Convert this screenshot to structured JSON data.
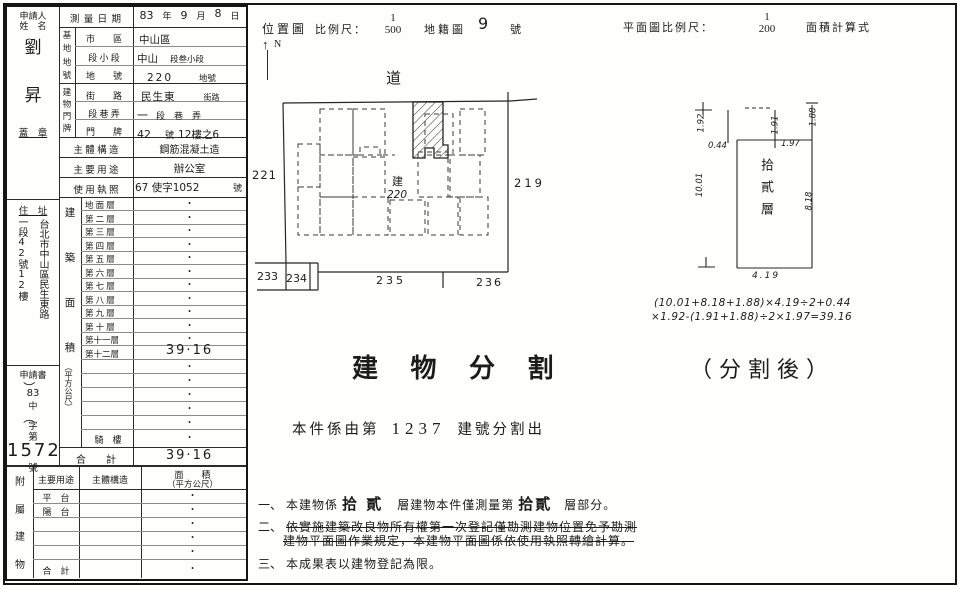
{
  "form": {
    "applicant": {
      "title_1": "申請人",
      "title_2": "姓　名",
      "name_1": "劉",
      "name_2": "昇",
      "seal": "蓋　章",
      "address_label": "住　址",
      "address_line_1": "台北市中山區民生東路",
      "address_line_2": "一段42號12樓",
      "app_doc": "申請書",
      "app_paren_open": "（",
      "app_year": "83",
      "app_mid": "中",
      "app_paren_close": "）",
      "app_word": "字",
      "app_no_label": "第",
      "app_number": "1572",
      "app_unit": "號"
    },
    "survey_date": {
      "label": "測 量 日 期",
      "year": "83",
      "year_u": "年",
      "month": "9",
      "month_u": "月",
      "day": "8",
      "day_u": "日"
    },
    "base": {
      "group_chars": [
        "基",
        "地",
        "地",
        "號"
      ],
      "rows": [
        {
          "label": "市　　區",
          "hw": "中山區",
          "pr": "",
          "hw2": ""
        },
        {
          "label": "段 小 段",
          "hw": "中山",
          "pr": "段叁小段",
          "hw2": ""
        },
        {
          "label": "地　　號",
          "hw": "220",
          "pr": "地號",
          "hw2": ""
        }
      ]
    },
    "door": {
      "group_chars": [
        "建",
        "物",
        "門",
        "牌"
      ],
      "rows": [
        {
          "label": "街　　路",
          "hw": "民生東",
          "pr": "街路",
          "hw2": ""
        },
        {
          "label": "段 巷 弄",
          "hw": "一",
          "pr": "段　巷　弄",
          "hw2": ""
        },
        {
          "label": "門　　牌",
          "hw": "42",
          "pr": "號",
          "hw2": "12樓之6"
        }
      ]
    },
    "structure": {
      "label": "主 體 構 造",
      "value": "鋼筋混凝土造"
    },
    "usage": {
      "label": "主 要 用 途",
      "value": "辦公室"
    },
    "license": {
      "label": "使 用 執 照",
      "hw": "67 使字1052",
      "pr": "號"
    },
    "area": {
      "group_chars": [
        "建",
        "築",
        "面",
        "積"
      ],
      "unit": "（平方公尺）",
      "floors": [
        {
          "label": "地 面 層",
          "value": "•"
        },
        {
          "label": "第 二 層",
          "value": "•"
        },
        {
          "label": "第 三 層",
          "value": "•"
        },
        {
          "label": "第 四 層",
          "value": "•"
        },
        {
          "label": "第 五 層",
          "value": "•"
        },
        {
          "label": "第 六 層",
          "value": "•"
        },
        {
          "label": "第 七 層",
          "value": "•"
        },
        {
          "label": "第 八 層",
          "value": "•"
        },
        {
          "label": "第 九 層",
          "value": "•"
        },
        {
          "label": "第 十 層",
          "value": "•"
        },
        {
          "label": "第十一層",
          "value": "•"
        },
        {
          "label": "第十二層",
          "value": "39·16"
        }
      ],
      "blank_values": [
        "•",
        "•",
        "•",
        "•",
        "•"
      ],
      "arcade": {
        "label": "騎　樓",
        "value": "•"
      },
      "total": {
        "label": "合　　計",
        "value": "39·16"
      }
    },
    "annex": {
      "group_chars": [
        "附",
        "屬",
        "建",
        "物"
      ],
      "headers": {
        "use": "主要用途",
        "structure": "主體構造",
        "area_1": "面　　積",
        "area_2": "（平方公尺）"
      },
      "rows": [
        {
          "use": "平　台",
          "area": "•"
        },
        {
          "use": "陽　台",
          "area": "•"
        },
        {
          "use": "",
          "area": "•"
        },
        {
          "use": "",
          "area": "•"
        },
        {
          "use": "",
          "area": "•"
        },
        {
          "use": "合　計",
          "area": "•"
        }
      ]
    }
  },
  "location": {
    "title": "位置圖",
    "scale_label": "比例尺：",
    "scale_num": "1",
    "scale_den": "500",
    "cadastral_label": "地籍圖",
    "sheet_no": "9",
    "sheet_unit": "號",
    "north": "N",
    "north_arrow": "↑",
    "road": "道",
    "parcels": {
      "left": "221",
      "right": "219",
      "b1": "233",
      "b2": "234",
      "b3": "235",
      "b4": "236",
      "subject_1": "建",
      "subject_2": "220"
    }
  },
  "plan": {
    "scale_label": "平面圖比例尺：",
    "scale_num": "1",
    "scale_den": "200",
    "calc_label": "面積計算式",
    "floor_label": "拾貳層",
    "dims": {
      "top_left": "1.92",
      "top_mid": "1.91",
      "top_right": "1.88",
      "inset_left": "0.44",
      "inset_right": "1.97",
      "side_left": "10.01",
      "side_right": "8.18",
      "bottom": "4.19"
    },
    "formula_1": "(10.01+8.18+1.88)×4.19÷2+0.44",
    "formula_2": "×1.92-(1.91+1.88)÷2×1.97=39.16",
    "after_split": "（分割後）"
  },
  "center": {
    "title": "建 物 分 割",
    "origin_pre": "本件係由第",
    "origin_no": "1237",
    "origin_post": "建號分割出"
  },
  "notes": {
    "n1_no": "一、",
    "n1_a": "本建物係",
    "n1_hw1": "拾 貳",
    "n1_b": "層建物本件僅測量第",
    "n1_hw2": "拾貳",
    "n1_c": "層部分。",
    "n2_no": "二、",
    "n2_line1": "依實施建築改良物所有權第一次登記僅勘測建物位置免予勘測",
    "n2_line2": "建物平面圖作業規定，本建物平面圖係依使用執照轉繪計算。",
    "n3_no": "三、",
    "n3_text": "本成果表以建物登記為限。"
  }
}
